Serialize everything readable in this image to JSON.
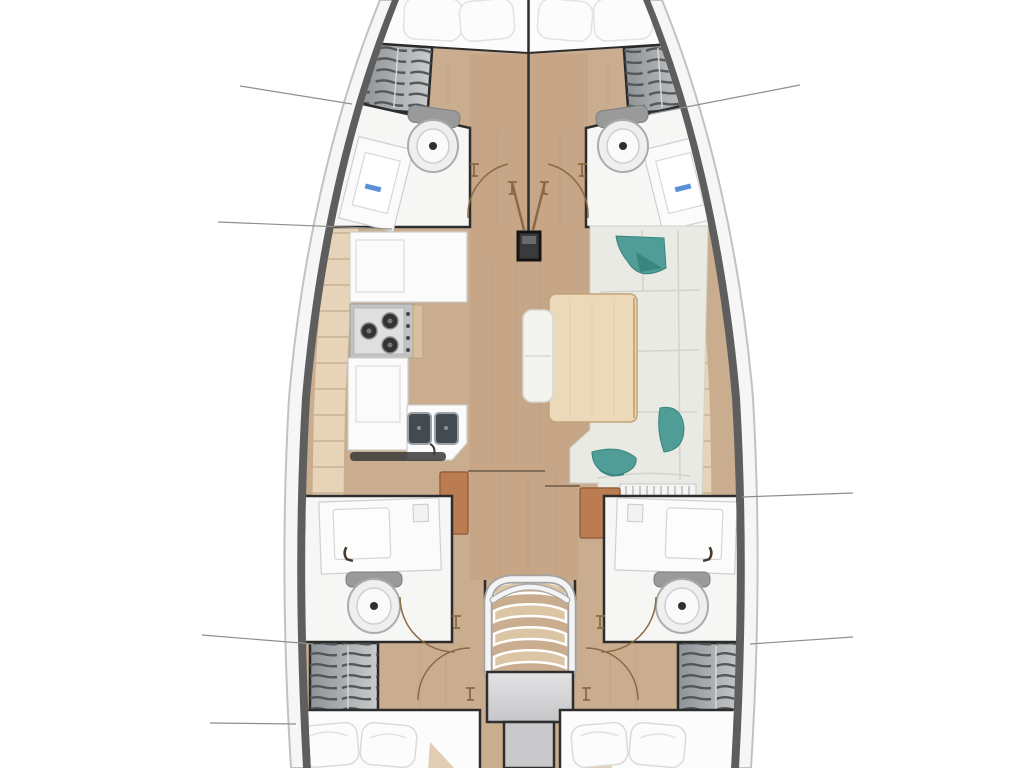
{
  "diagram": {
    "kind": "yacht-interior-floorplan",
    "orientation": "bow-up",
    "text_labels": [],
    "components": {
      "bow": [
        "forward-berth-port",
        "forward-berth-starboard",
        "shelf-locker-port",
        "shelf-locker-starboard"
      ],
      "forward": [
        "head-port (sink, toilet)",
        "head-starboard (sink, toilet)",
        "mast-post",
        "cabin-doors"
      ],
      "midship": [
        "galley (fridge, stove-3-burner, lockers, double-sink)",
        "salon (L-sofa, cushions, table, bench, step-grate)"
      ],
      "aft": [
        "head-port (sink, toilet)",
        "head-starboard (sink, toilet)",
        "companionway-stairs",
        "shelf-locker-port",
        "shelf-locker-starboard",
        "aft-berth-port",
        "aft-berth-starboard"
      ],
      "annotations": [
        "leader-line x7"
      ]
    }
  },
  "palette": {
    "bg": "#ffffff",
    "deckWhite": "#f6f6f6",
    "hullLine": "#c2c2c2",
    "linerGray": "#5e5e5e",
    "wood": "#c9ad8e",
    "woodMid": "#c2a17f",
    "woodLight": "#e7d4b8",
    "plankLine": "#c8b294",
    "wallDark": "#2d2d2d",
    "roomWhite": "#f6f6f5",
    "counterWhite": "#fbfbfb",
    "counterLine": "#cfcfcf",
    "sofaLight": "#e9eae3",
    "sofaSeam": "#d2d3ca",
    "teal": "#4f9d96",
    "tealDark": "#39857f",
    "tableWood": "#ecd9ba",
    "tableEdge": "#bfa478",
    "terracotta": "#bc7c52",
    "stoveFrame": "#c2c2c2",
    "stoveTop": "#dfdfdf",
    "burnerDark": "#333333",
    "sinkDark": "#434a50",
    "lockerA": "#8f9397",
    "lockerB": "#c9cbcc",
    "hatchLine": "#515659",
    "stairTread": "#dcc5a5",
    "railWhite": "#f4f4f4",
    "landingA": "#e3e3e5",
    "landingB": "#c6c6c8",
    "columnGray": "#c9c9cb",
    "bedWhite": "#fcfcfc",
    "bedShade": "#e2e2e2",
    "calloutGray": "#8f8f8f",
    "doorBrown": "#8a6a45",
    "faucetBlue": "#5b8fd6",
    "tankGray": "#9a9a9a",
    "shadowDark": "#3a3a3a"
  }
}
